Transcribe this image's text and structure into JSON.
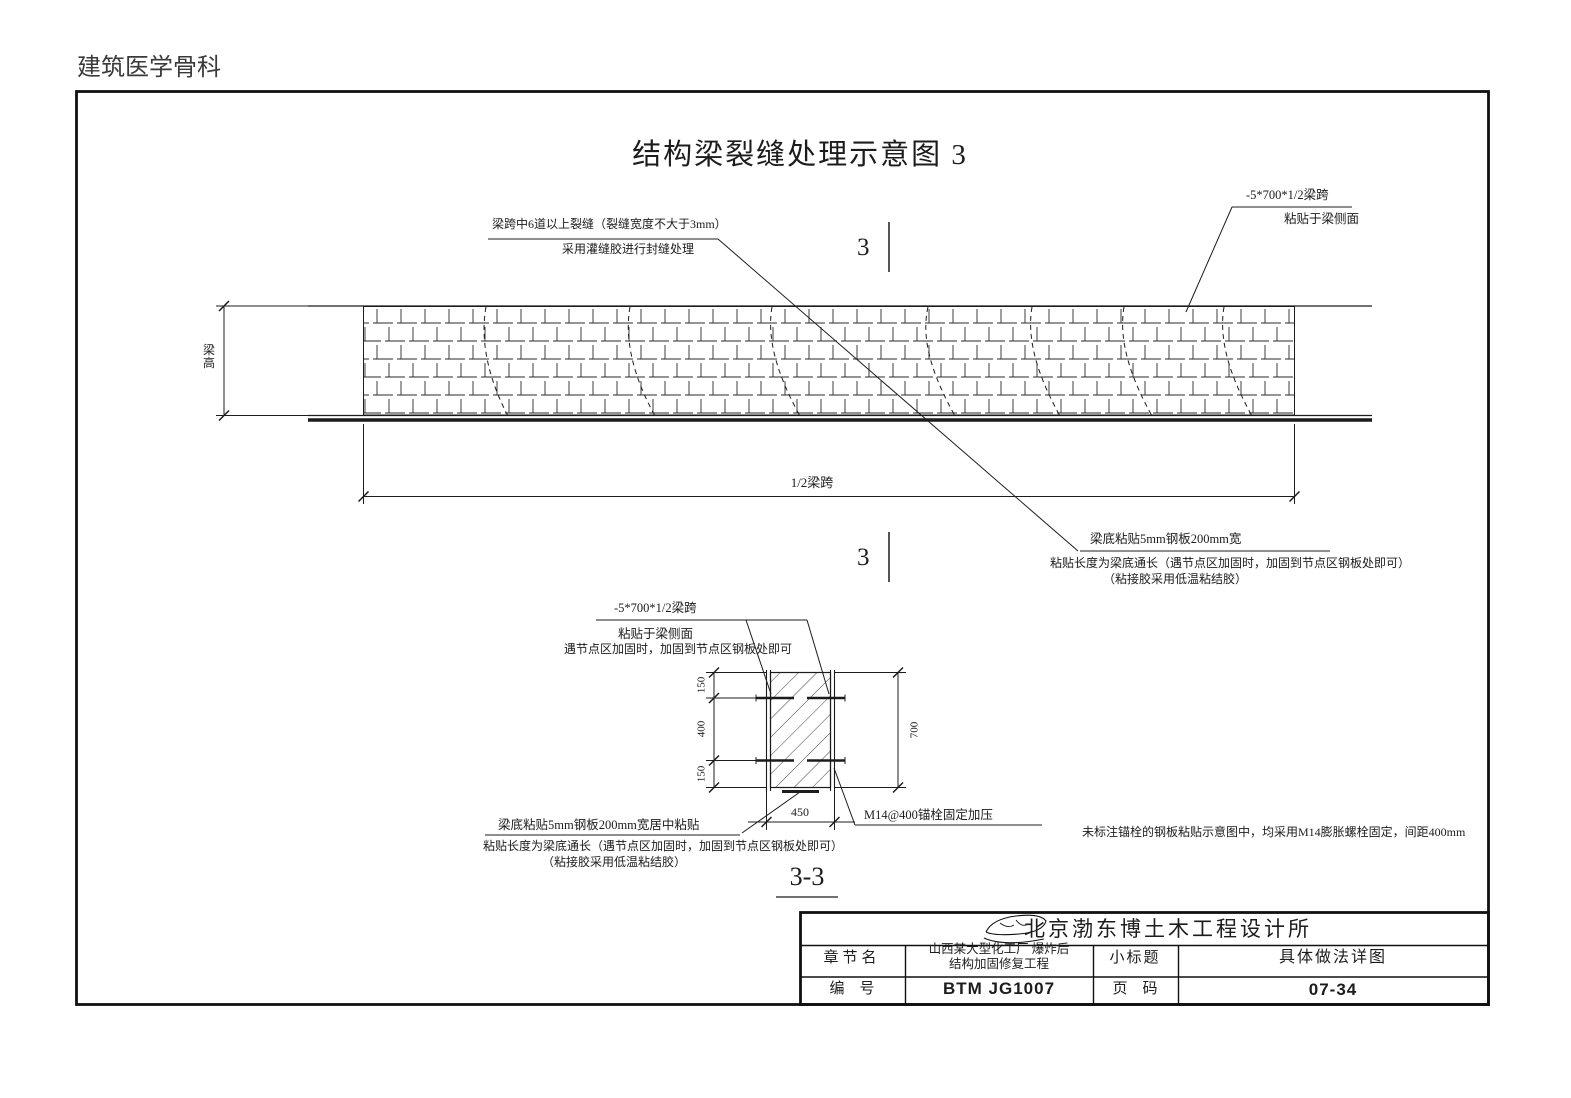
{
  "page": {
    "watermark": "建筑医学骨科",
    "title": "结构梁裂缝处理示意图 3"
  },
  "elevation": {
    "section_mark": "3",
    "beam_height": "梁高",
    "half_span": "1/2梁跨",
    "crack_note": {
      "line1": "梁跨中6道以上裂缝（裂缝宽度不大于3mm）",
      "line2": "采用灌缝胶进行封缝处理"
    },
    "side_plate_note": {
      "line1": "-5*700*1/2梁跨",
      "line2": "粘贴于梁侧面"
    },
    "bottom_plate_note": {
      "line1": "梁底粘贴5mm钢板200mm宽",
      "line2": "粘贴长度为梁底通长（遇节点区加固时，加固到节点区钢板处即可）",
      "line3": "（粘接胶采用低温粘结胶）"
    }
  },
  "section": {
    "label": "3-3",
    "plate_note": {
      "line1": "-5*700*1/2梁跨",
      "line2": "粘贴于梁侧面",
      "line3": "遇节点区加固时，加固到节点区钢板处即可"
    },
    "dims": {
      "top": "150",
      "middle": "400",
      "bottom": "150",
      "height": "700",
      "width": "450"
    },
    "anchor_note": "M14@400锚栓固定加压",
    "bottom_note": {
      "line1": "梁底粘贴5mm钢板200mm宽居中粘贴",
      "line2": "粘贴长度为梁底通长（遇节点区加固时，加固到节点区钢板处即可）",
      "line3": "（粘接胶采用低温粘结胶）"
    },
    "general_note": "未标注锚栓的钢板粘贴示意图中，均采用M14膨胀螺栓固定，间距400mm"
  },
  "titleblock": {
    "company": "北京渤东博土木工程设计所",
    "chapter_label": "章节名",
    "project_line1": "山西某大型化工厂 爆炸后",
    "project_line2": "结构加固修复工程",
    "subtitle_label": "小标题",
    "subtitle": "具体做法详图",
    "number_label": "编　号",
    "number": "BTM JG1007",
    "page_label": "页　码",
    "page_code": "07-34"
  }
}
